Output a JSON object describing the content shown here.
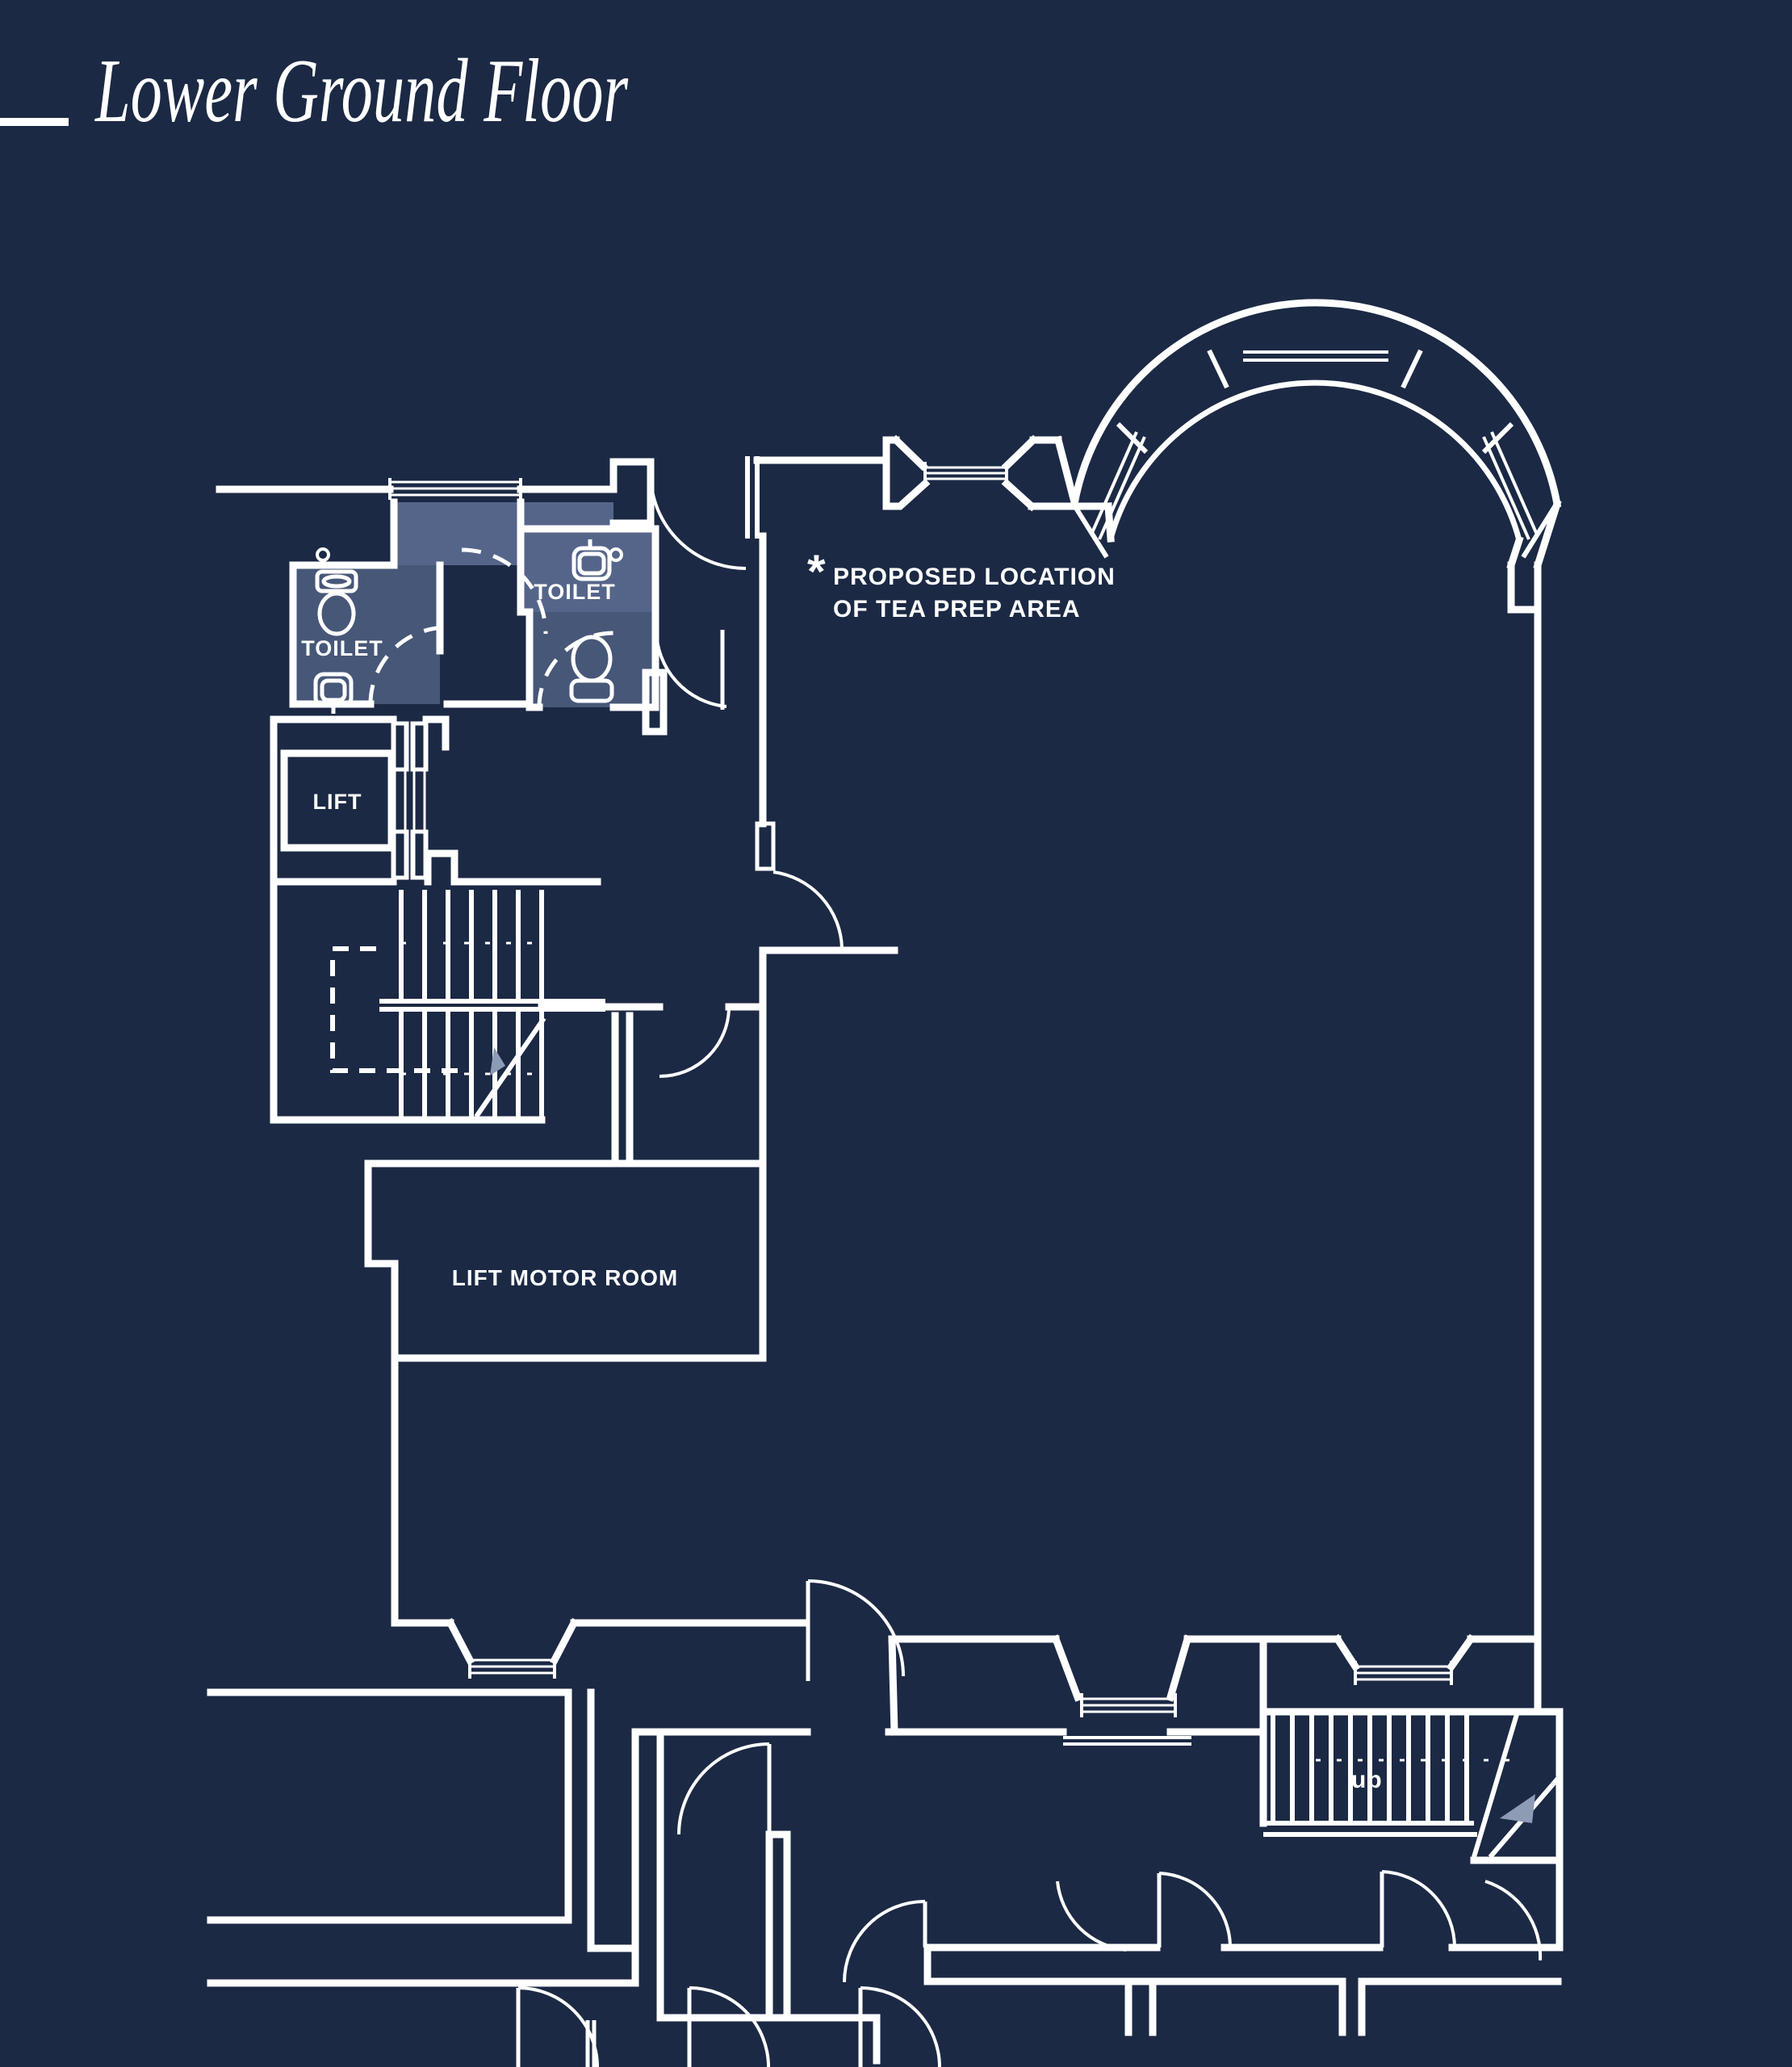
{
  "title": "Lower Ground Floor",
  "labels": {
    "toilet_left": "TOILET",
    "toilet_middle": "TOILET",
    "lift": "LIFT",
    "lift_motor_room": "LIFT MOTOR ROOM",
    "note_marker": "*",
    "note_line1": "PROPOSED LOCATION",
    "note_line2": "OF TEA PREP AREA",
    "stairs_up": "up"
  },
  "colors": {
    "background": "#1b2944",
    "line": "#ffffff",
    "room_highlight": "#475778",
    "room_highlight_light": "#55658a",
    "arrow_fill": "#8e9bb5"
  }
}
